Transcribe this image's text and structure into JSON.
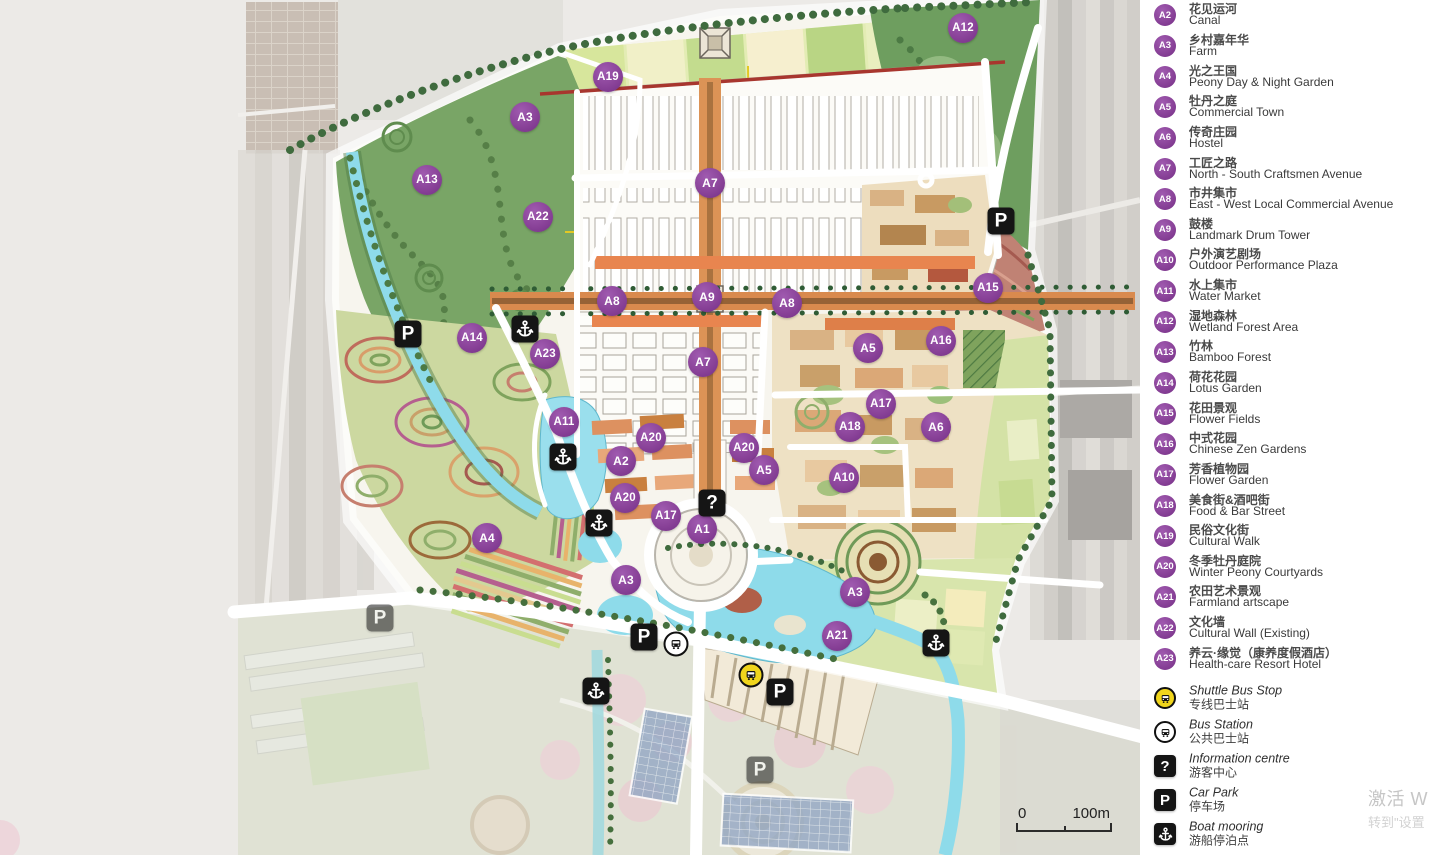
{
  "legend": {
    "items": [
      {
        "id": "A2",
        "zh": "花见运河",
        "en": "Canal"
      },
      {
        "id": "A3",
        "zh": "乡村嘉年华",
        "en": "Farm"
      },
      {
        "id": "A4",
        "zh": "光之王国",
        "en": "Peony Day & Night Garden"
      },
      {
        "id": "A5",
        "zh": "牡丹之庭",
        "en": "Commercial Town"
      },
      {
        "id": "A6",
        "zh": "传奇庄园",
        "en": "Hostel"
      },
      {
        "id": "A7",
        "zh": "工匠之路",
        "en": "North - South Craftsmen Avenue"
      },
      {
        "id": "A8",
        "zh": "市井集市",
        "en": "East - West Local Commercial Avenue"
      },
      {
        "id": "A9",
        "zh": "鼓楼",
        "en": "Landmark Drum Tower"
      },
      {
        "id": "A10",
        "zh": "户外演艺剧场",
        "en": "Outdoor Performance Plaza"
      },
      {
        "id": "A11",
        "zh": "水上集市",
        "en": "Water Market"
      },
      {
        "id": "A12",
        "zh": "湿地森林",
        "en": "Wetland Forest Area"
      },
      {
        "id": "A13",
        "zh": "竹林",
        "en": "Bamboo Forest"
      },
      {
        "id": "A14",
        "zh": "荷花花园",
        "en": "Lotus Garden"
      },
      {
        "id": "A15",
        "zh": "花田景观",
        "en": "Flower Fields"
      },
      {
        "id": "A16",
        "zh": "中式花园",
        "en": "Chinese Zen Gardens"
      },
      {
        "id": "A17",
        "zh": "芳香植物园",
        "en": "Flower Garden"
      },
      {
        "id": "A18",
        "zh": "美食街&酒吧街",
        "en": "Food & Bar Street"
      },
      {
        "id": "A19",
        "zh": "民俗文化街",
        "en": "Cultural Walk"
      },
      {
        "id": "A20",
        "zh": "冬季牡丹庭院",
        "en": "Winter Peony Courtyards"
      },
      {
        "id": "A21",
        "zh": "农田艺术景观",
        "en": "Farmland artscape"
      },
      {
        "id": "A22",
        "zh": "文化墙",
        "en": "Cultural Wall (Existing)"
      },
      {
        "id": "A23",
        "zh": "养云·缘觉（康养度假酒店）",
        "en": "Health-care Resort Hotel"
      }
    ],
    "transport": [
      {
        "icon": "shuttle-bus",
        "en": "Shuttle Bus Stop",
        "zh": "专线巴士站"
      },
      {
        "icon": "bus-station",
        "en": "Bus Station",
        "zh": "公共巴士站"
      },
      {
        "icon": "information",
        "en": "Information centre",
        "zh": "游客中心"
      },
      {
        "icon": "car-park",
        "en": "Car Park",
        "zh": "停车场"
      },
      {
        "icon": "boat-mooring",
        "en": "Boat mooring",
        "zh": "游船停泊点"
      }
    ]
  },
  "map": {
    "markers": [
      {
        "label": "A12",
        "x": 963,
        "y": 28
      },
      {
        "label": "A19",
        "x": 608,
        "y": 77
      },
      {
        "label": "A3",
        "x": 525,
        "y": 117
      },
      {
        "label": "A13",
        "x": 427,
        "y": 180
      },
      {
        "label": "A7",
        "x": 710,
        "y": 183
      },
      {
        "label": "A22",
        "x": 538,
        "y": 217
      },
      {
        "label": "A15",
        "x": 988,
        "y": 288
      },
      {
        "label": "A9",
        "x": 707,
        "y": 297
      },
      {
        "label": "A8",
        "x": 612,
        "y": 301
      },
      {
        "label": "A8",
        "x": 787,
        "y": 303
      },
      {
        "label": "A14",
        "x": 472,
        "y": 338
      },
      {
        "label": "A16",
        "x": 941,
        "y": 341
      },
      {
        "label": "A5",
        "x": 868,
        "y": 348
      },
      {
        "label": "A23",
        "x": 545,
        "y": 354
      },
      {
        "label": "A7",
        "x": 703,
        "y": 362
      },
      {
        "label": "A17",
        "x": 881,
        "y": 404
      },
      {
        "label": "A11",
        "x": 564,
        "y": 422
      },
      {
        "label": "A18",
        "x": 850,
        "y": 427
      },
      {
        "label": "A6",
        "x": 936,
        "y": 427
      },
      {
        "label": "A20",
        "x": 651,
        "y": 438
      },
      {
        "label": "A20",
        "x": 744,
        "y": 448
      },
      {
        "label": "A2",
        "x": 621,
        "y": 461
      },
      {
        "label": "A5",
        "x": 764,
        "y": 470
      },
      {
        "label": "A10",
        "x": 844,
        "y": 478
      },
      {
        "label": "A20",
        "x": 625,
        "y": 498
      },
      {
        "label": "A17",
        "x": 666,
        "y": 516
      },
      {
        "label": "A1",
        "x": 702,
        "y": 529
      },
      {
        "label": "A4",
        "x": 487,
        "y": 538
      },
      {
        "label": "A3",
        "x": 626,
        "y": 580
      },
      {
        "label": "A3",
        "x": 855,
        "y": 592
      },
      {
        "label": "A21",
        "x": 837,
        "y": 636
      }
    ],
    "icons": [
      {
        "type": "car-park",
        "x": 1001,
        "y": 221
      },
      {
        "type": "boat-mooring",
        "x": 525,
        "y": 329
      },
      {
        "type": "car-park",
        "x": 408,
        "y": 334
      },
      {
        "type": "boat-mooring",
        "x": 563,
        "y": 457
      },
      {
        "type": "information",
        "x": 712,
        "y": 503
      },
      {
        "type": "boat-mooring",
        "x": 599,
        "y": 523
      },
      {
        "type": "car-park",
        "x": 380,
        "y": 618,
        "faded": true
      },
      {
        "type": "car-park",
        "x": 644,
        "y": 637
      },
      {
        "type": "bus-station",
        "x": 676,
        "y": 644
      },
      {
        "type": "boat-mooring",
        "x": 936,
        "y": 643
      },
      {
        "type": "shuttle-bus",
        "x": 751,
        "y": 675
      },
      {
        "type": "car-park",
        "x": 780,
        "y": 692
      },
      {
        "type": "boat-mooring",
        "x": 596,
        "y": 691
      },
      {
        "type": "car-park",
        "x": 760,
        "y": 770,
        "faded": true
      }
    ],
    "glyphs": {
      "car_park": "P",
      "information": "?"
    },
    "scale_bar": {
      "start": "0",
      "end": "100m"
    }
  },
  "watermark": {
    "line1": "激活 W",
    "line2": "转到\"设置"
  },
  "colors": {
    "marker_purple": "#8a4399",
    "shuttle_yellow": "#f0d51c",
    "icon_black": "#151515",
    "water": "#8edbea"
  }
}
